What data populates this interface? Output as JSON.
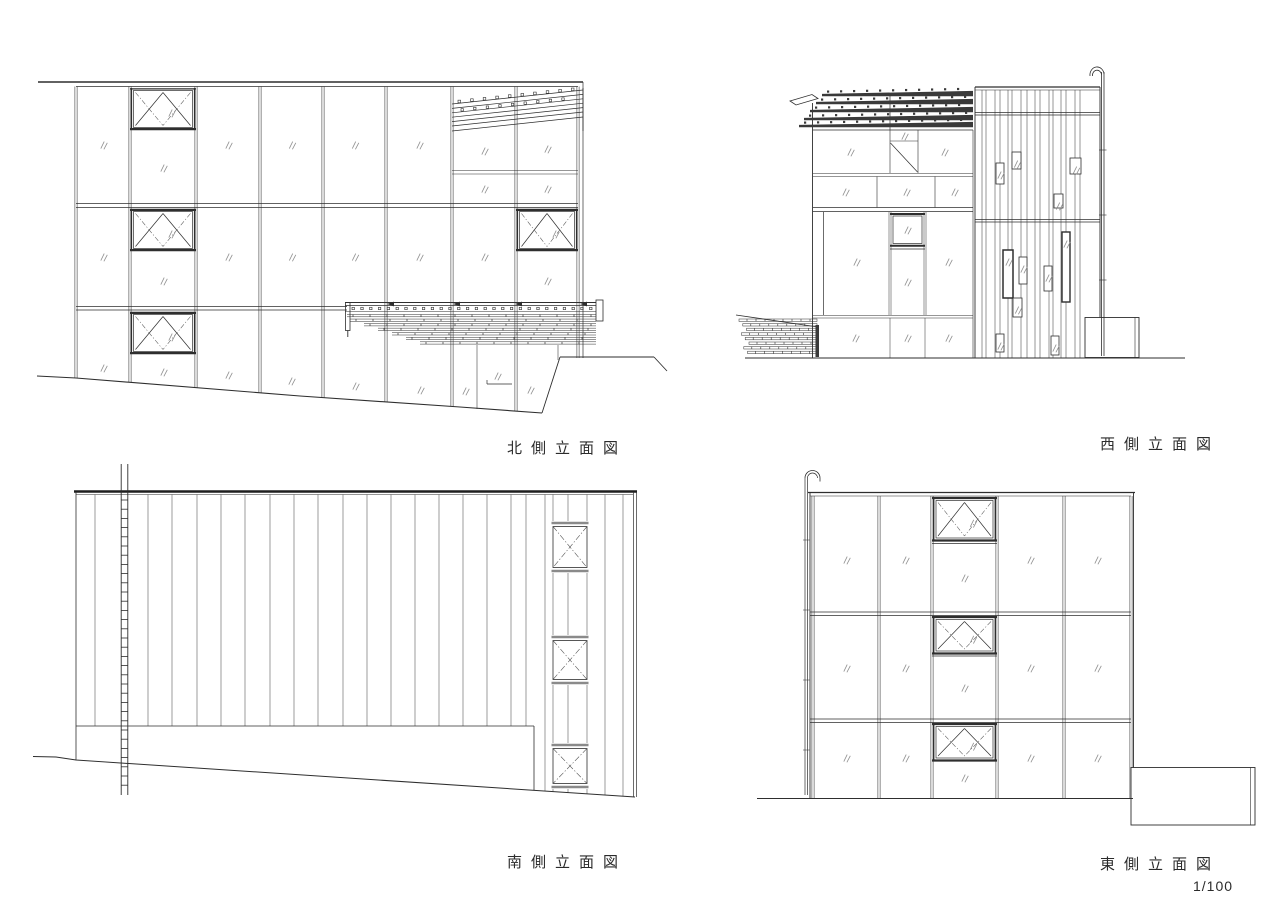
{
  "sheet": {
    "type": "architectural-elevation-sheet",
    "scale_label": "1/100",
    "line_color": "#2e2e2e",
    "glass_mark_color": "#8f8f8f",
    "background": "#ffffff"
  },
  "drawings": [
    {
      "id": "north",
      "label": "北側立面図"
    },
    {
      "id": "west",
      "label": "西側立面図"
    },
    {
      "id": "south",
      "label": "南側立面図"
    },
    {
      "id": "east",
      "label": "東側立面図"
    }
  ]
}
